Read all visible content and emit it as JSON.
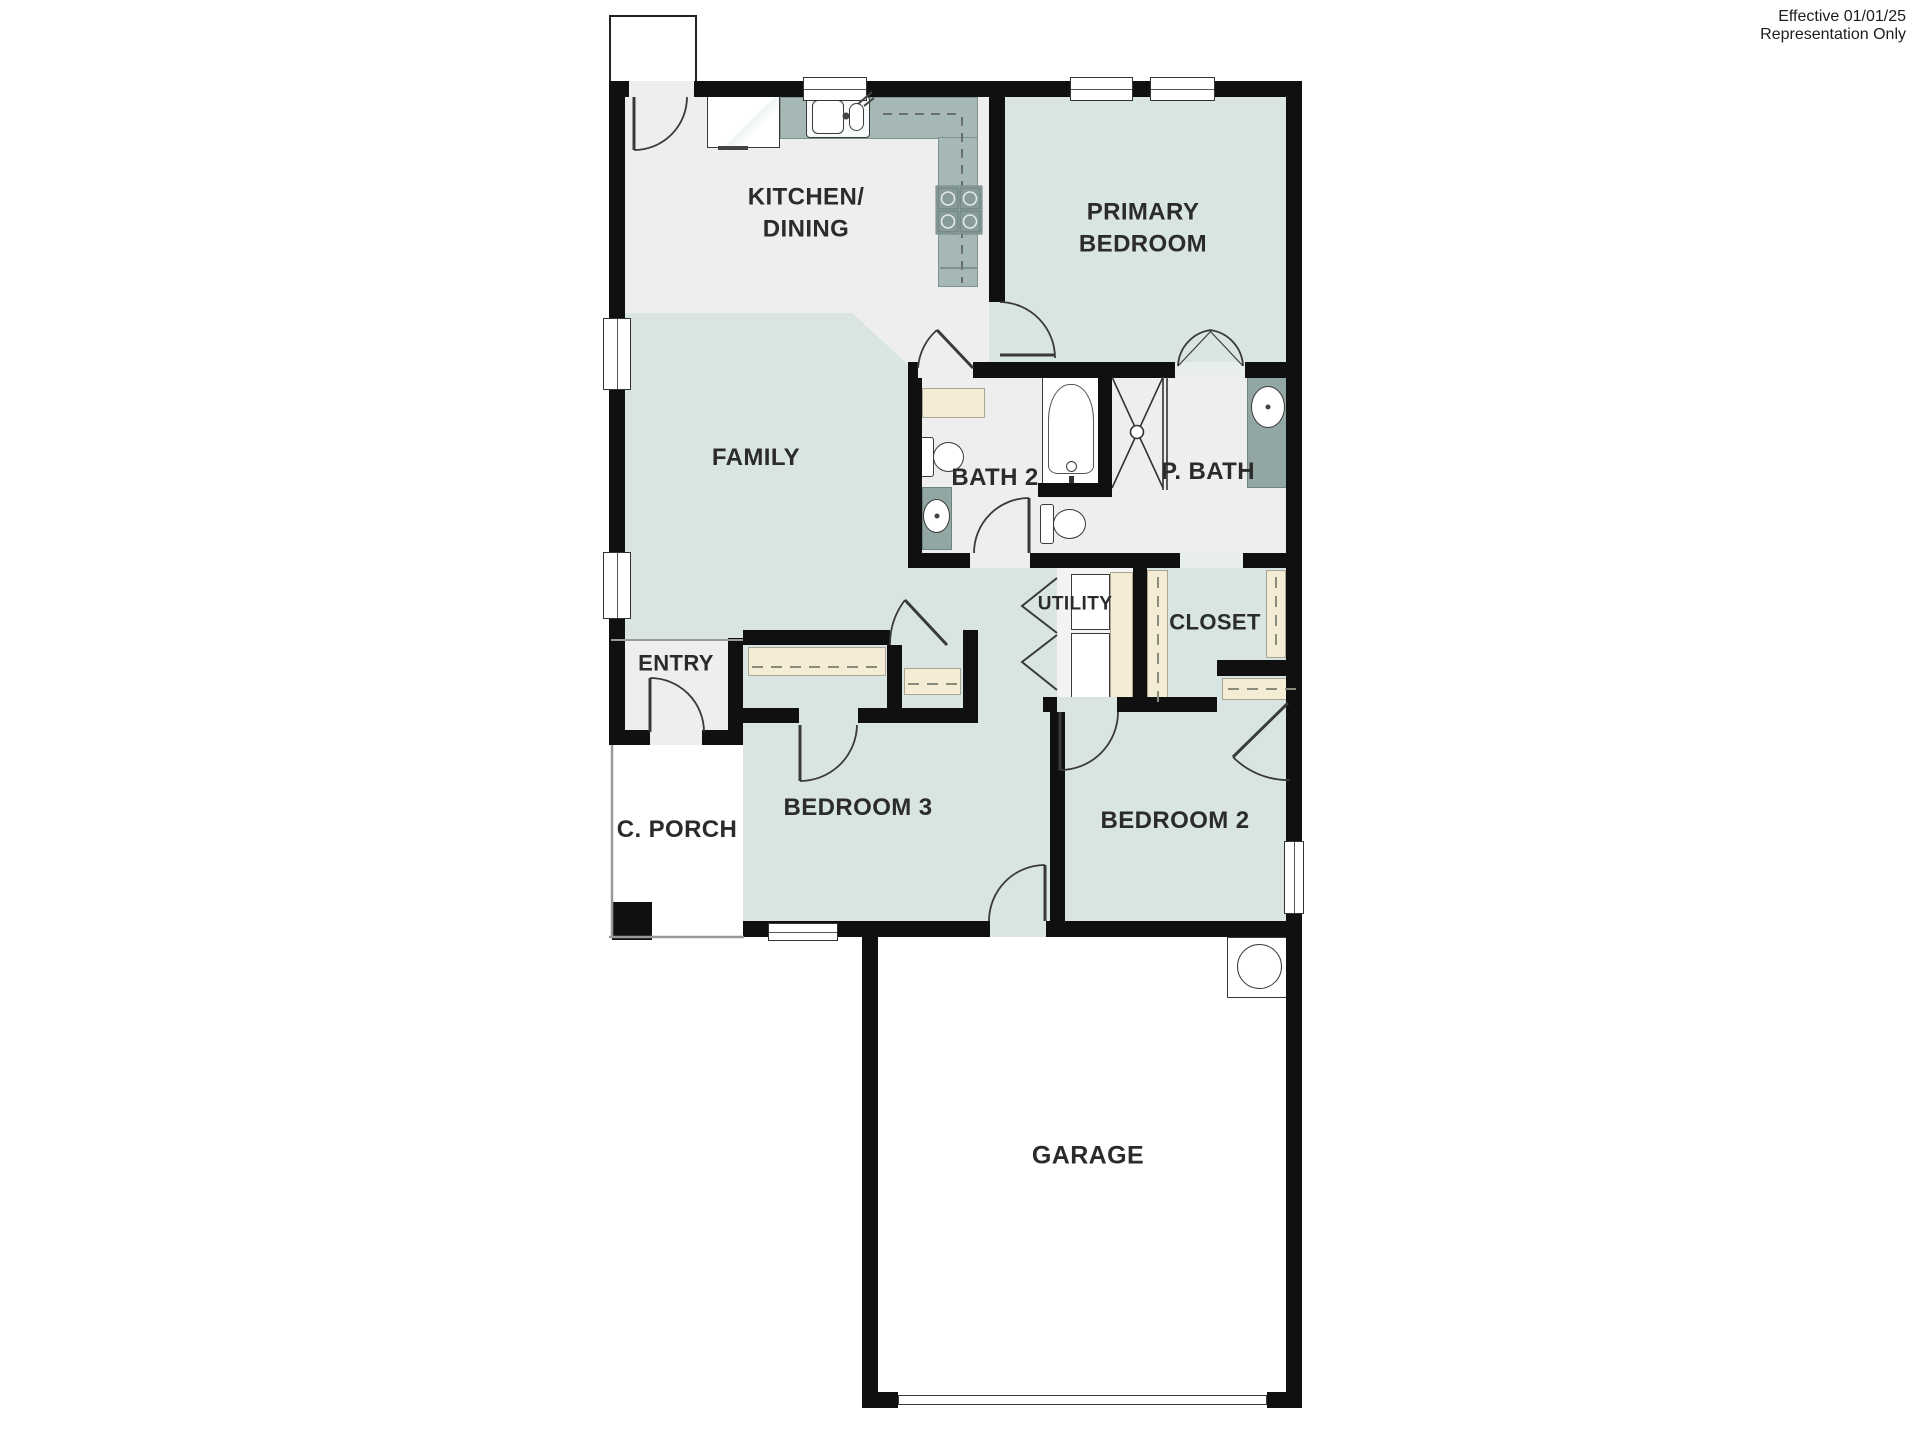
{
  "annotation": {
    "line1": "Effective 01/01/25",
    "line2": "Representation Only"
  },
  "rooms": {
    "kitchen": "KITCHEN/\nDINING",
    "primary_bedroom": "PRIMARY\nBEDROOM",
    "family": "FAMILY",
    "bath2": "BATH 2",
    "p_bath": "P. BATH",
    "utility": "UTILITY",
    "closet": "CLOSET",
    "entry": "ENTRY",
    "c_porch": "C. PORCH",
    "bedroom3": "BEDROOM 3",
    "bedroom2": "BEDROOM 2",
    "garage": "GARAGE"
  },
  "colors": {
    "wall": "#101010",
    "room_fill_blue": "#d9e5e2",
    "floor_gray": "#eeeeee",
    "counter_green": "#a5b8b6",
    "vanity_green": "#92a6a4",
    "casework_cream": "#f5ecd5"
  }
}
